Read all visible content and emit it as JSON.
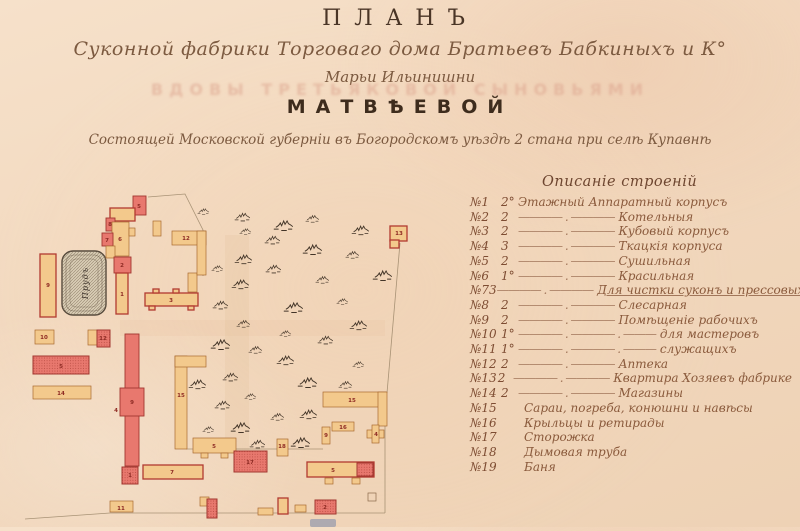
{
  "header": {
    "title": "ПЛАНЪ",
    "subtitle1": "Суконной фабрики Торговаго дома Братьевъ Бабкиныхъ и К°",
    "subtitle2": "Марьи Ильинишни",
    "bleed_through": "ВДОВЫ ТРЕТЬЯКОВОЙ СЫНОВЬЯМИ",
    "owner": "МАТВѢЕВОЙ",
    "location": "Состоящей Московской губерніи въ Богородскомъ уѣздѣ 2 стана при селѣ Купавнѣ"
  },
  "legend": {
    "header": "Описаніе строеній",
    "rows": [
      {
        "num": "№1",
        "storeys": "2°",
        "leader": "",
        "name": "Этажный Аппаратный корпусъ",
        "u": false
      },
      {
        "num": "№2",
        "storeys": "2",
        "leader": "———— . ————",
        "name": "Котельныя",
        "u": false
      },
      {
        "num": "№3",
        "storeys": "2",
        "leader": "———— . ————",
        "name": "Кубовый корпусъ",
        "u": false
      },
      {
        "num": "№4",
        "storeys": "3",
        "leader": "———— . ————",
        "name": "Ткацкія корпуса",
        "u": false
      },
      {
        "num": "№5",
        "storeys": "2",
        "leader": "———— . ————",
        "name": "Сушильная",
        "u": false
      },
      {
        "num": "№6",
        "storeys": "1°",
        "leader": "———— . ————",
        "name": "Красильная",
        "u": false
      },
      {
        "num": "№7",
        "storeys": "3",
        "leader": "———— . ————",
        "name": "Для чистки суконъ и прессовыхъ",
        "u": true
      },
      {
        "num": "№8",
        "storeys": "2",
        "leader": "———— . ————",
        "name": "Слесарная",
        "u": false
      },
      {
        "num": "№9",
        "storeys": "2",
        "leader": "———— . ————",
        "name": "Помѣщеніе рабочихъ",
        "u": false
      },
      {
        "num": "№10",
        "storeys": "1°",
        "leader": "———— . ———— . ———",
        "name": "для мастеровъ",
        "u": false
      },
      {
        "num": "№11",
        "storeys": "1°",
        "leader": "———— . ———— . ———",
        "name": "служащихъ",
        "u": false
      },
      {
        "num": "№12",
        "storeys": "2",
        "leader": "———— . ————",
        "name": "Аптека",
        "u": false
      },
      {
        "num": "№13",
        "storeys": "2",
        "leader": "———— . ————",
        "name": "Квартира Хозяевъ фабрике",
        "u": false
      },
      {
        "num": "№14",
        "storeys": "2",
        "leader": "———— . ————",
        "name": "Магазины",
        "u": false
      },
      {
        "num": "№15",
        "storeys": "",
        "leader": "",
        "name": "Сараи, погреба, конюшни и навѣсы",
        "u": false
      },
      {
        "num": "№16",
        "storeys": "",
        "leader": "",
        "name": "Крыльцы и ретирады",
        "u": false
      },
      {
        "num": "№17",
        "storeys": "",
        "leader": "",
        "name": "Сторожка",
        "u": false
      },
      {
        "num": "№18",
        "storeys": "",
        "leader": "",
        "name": "Дымовая труба",
        "u": false
      },
      {
        "num": "№19",
        "storeys": "",
        "leader": "",
        "name": "Баня",
        "u": false
      }
    ]
  },
  "map": {
    "colors": {
      "red_fill": "#e8786e",
      "red_stroke": "#a23730",
      "red_dot": "#b84c42",
      "tan_fill": "#f3c98c",
      "tan_stroke": "#a96a30",
      "tan_red_stroke": "#b23a31",
      "outline_ink": "#9b8668",
      "tree_ink": "#433528",
      "label_ink": "#8e2b24",
      "pond_fill": "#d8ccb4",
      "pond_stroke": "#564a3c"
    },
    "pond": {
      "x": 37,
      "y": 71,
      "w": 44,
      "h": 64,
      "label": "Прудъ"
    },
    "outlines": [
      {
        "points": [
          [
            123,
            17
          ],
          [
            160,
            14
          ],
          [
            178,
            50
          ],
          [
            178,
            96
          ]
        ]
      },
      {
        "points": [
          [
            375,
            63
          ],
          [
            362,
            213
          ]
        ]
      },
      {
        "points": [
          [
            161,
            269
          ],
          [
            298,
            269
          ]
        ]
      },
      {
        "points": [
          [
            360,
            245
          ],
          [
            360,
            333
          ]
        ]
      },
      {
        "points": [
          [
            85,
            333
          ],
          [
            360,
            333
          ]
        ]
      },
      {
        "points": [
          [
            0,
            339
          ],
          [
            85,
            333
          ]
        ]
      }
    ],
    "buildings": [
      {
        "rects": [
          [
            108,
            16,
            13,
            19
          ]
        ],
        "style": "red",
        "label": "5",
        "lx": 114,
        "ly": 28
      },
      {
        "rects": [
          [
            85,
            28,
            25,
            13
          ]
        ],
        "style": "tanRed"
      },
      {
        "rects": [
          [
            128,
            41,
            8,
            15
          ]
        ],
        "style": "tan"
      },
      {
        "rects": [
          [
            81,
            38,
            9,
            13
          ]
        ],
        "style": "red",
        "label": "8",
        "lx": 85,
        "ly": 46
      },
      {
        "rects": [
          [
            87,
            42,
            17,
            34
          ]
        ],
        "style": "tan",
        "label": "6",
        "lx": 95,
        "ly": 61
      },
      {
        "rects": [
          [
            104,
            48,
            6,
            8
          ]
        ],
        "style": "tan"
      },
      {
        "rects": [
          [
            77,
            53,
            11,
            13
          ]
        ],
        "style": "red",
        "label": "7",
        "lx": 82,
        "ly": 62
      },
      {
        "rects": [
          [
            81,
            66,
            9,
            12
          ]
        ],
        "style": "tan"
      },
      {
        "rects": [
          [
            89,
            77,
            17,
            16
          ]
        ],
        "style": "red",
        "label": "2",
        "lx": 97,
        "ly": 87
      },
      {
        "rects": [
          [
            91,
            93,
            12,
            41
          ]
        ],
        "style": "tanRed",
        "label": "1",
        "lx": 97,
        "ly": 116
      },
      {
        "rects": [
          [
            163,
            93,
            9,
            19
          ]
        ],
        "style": "tan"
      },
      {
        "rects": [
          [
            120,
            113,
            53,
            13
          ],
          [
            128,
            109,
            6,
            4
          ],
          [
            148,
            109,
            6,
            4
          ],
          [
            124,
            126,
            6,
            4
          ],
          [
            163,
            126,
            6,
            4
          ]
        ],
        "style": "tanRed",
        "label": "3",
        "lx": 146,
        "ly": 122
      },
      {
        "rects": [
          [
            147,
            51,
            34,
            14
          ],
          [
            172,
            51,
            9,
            44
          ]
        ],
        "style": "tan",
        "label": "12",
        "lx": 161,
        "ly": 60
      },
      {
        "rects": [
          [
            15,
            74,
            16,
            63
          ]
        ],
        "style": "tanRed",
        "label": "9",
        "lx": 23,
        "ly": 107
      },
      {
        "rects": [
          [
            10,
            150,
            19,
            14
          ]
        ],
        "style": "tan",
        "label": "10",
        "lx": 19,
        "ly": 159
      },
      {
        "rects": [
          [
            63,
            150,
            9,
            15
          ]
        ],
        "style": "tan"
      },
      {
        "rects": [
          [
            72,
            150,
            13,
            17
          ]
        ],
        "style": "redDot",
        "label": "12",
        "lx": 78,
        "ly": 160
      },
      {
        "rects": [
          [
            8,
            176,
            56,
            18
          ]
        ],
        "style": "redDot",
        "label": "5",
        "lx": 36,
        "ly": 188
      },
      {
        "rects": [
          [
            8,
            206,
            58,
            13
          ]
        ],
        "style": "tan",
        "label": "14",
        "lx": 36,
        "ly": 215
      },
      {
        "rects": [
          [
            100,
            154,
            14,
            132
          ]
        ],
        "style": "red"
      },
      {
        "rects": [
          [
            95,
            208,
            24,
            28
          ]
        ],
        "style": "red",
        "label": "9",
        "lx": 107,
        "ly": 224
      },
      {
        "rects": [],
        "style": "red",
        "label": "4",
        "lx": 91,
        "ly": 232
      },
      {
        "rects": [
          [
            97,
            287,
            16,
            17
          ]
        ],
        "style": "redDot",
        "label": "1",
        "lx": 105,
        "ly": 297
      },
      {
        "rects": [
          [
            118,
            285,
            60,
            14
          ]
        ],
        "style": "tanRed",
        "label": "7",
        "lx": 147,
        "ly": 294
      },
      {
        "rects": [
          [
            85,
            321,
            23,
            11
          ]
        ],
        "style": "tan",
        "label": "11",
        "lx": 96,
        "ly": 330
      },
      {
        "rects": [
          [
            150,
            176,
            12,
            93
          ],
          [
            150,
            176,
            31,
            11
          ]
        ],
        "style": "tan",
        "label": "15",
        "lx": 156,
        "ly": 217
      },
      {
        "rects": [
          [
            168,
            258,
            43,
            15
          ],
          [
            176,
            273,
            7,
            5
          ],
          [
            196,
            273,
            7,
            5
          ]
        ],
        "style": "tan",
        "label": "5",
        "lx": 189,
        "ly": 268
      },
      {
        "rects": [
          [
            209,
            271,
            33,
            21
          ]
        ],
        "style": "redDot",
        "label": "17",
        "lx": 225,
        "ly": 284
      },
      {
        "rects": [
          [
            252,
            259,
            11,
            17
          ]
        ],
        "style": "tan",
        "label": "18",
        "lx": 257,
        "ly": 268
      },
      {
        "rects": [
          [
            175,
            317,
            9,
            9
          ]
        ],
        "style": "tan"
      },
      {
        "rects": [
          [
            182,
            319,
            10,
            19
          ]
        ],
        "style": "redDot"
      },
      {
        "rects": [
          [
            233,
            328,
            15,
            7
          ]
        ],
        "style": "tan"
      },
      {
        "rects": [
          [
            253,
            318,
            10,
            16
          ]
        ],
        "style": "tanRed"
      },
      {
        "rects": [
          [
            270,
            325,
            11,
            7
          ]
        ],
        "style": "tan"
      },
      {
        "rects": [
          [
            290,
            320,
            21,
            14
          ]
        ],
        "style": "redDot",
        "label": "2",
        "lx": 300,
        "ly": 329
      },
      {
        "rects": [
          [
            343,
            313,
            8,
            8
          ]
        ],
        "style": "outline"
      },
      {
        "rects": [
          [
            298,
            212,
            63,
            15
          ],
          [
            353,
            212,
            9,
            34
          ]
        ],
        "style": "tan",
        "label": "15",
        "lx": 327,
        "ly": 222
      },
      {
        "rects": [
          [
            307,
            242,
            22,
            9
          ]
        ],
        "style": "tan",
        "label": "16",
        "lx": 318,
        "ly": 249
      },
      {
        "rects": [
          [
            297,
            247,
            8,
            17
          ]
        ],
        "style": "tan",
        "label": "9",
        "lx": 301,
        "ly": 257
      },
      {
        "rects": [
          [
            342,
            250,
            17,
            8
          ],
          [
            347,
            245,
            7,
            18
          ]
        ],
        "style": "tan",
        "label": "4",
        "lx": 351,
        "ly": 256
      },
      {
        "rects": [
          [
            282,
            282,
            67,
            15
          ]
        ],
        "style": "tanRed",
        "label": "5",
        "lx": 308,
        "ly": 292
      },
      {
        "rects": [
          [
            332,
            283,
            16,
            13
          ]
        ],
        "style": "redDot"
      },
      {
        "rects": [
          [
            300,
            298,
            8,
            6
          ],
          [
            327,
            298,
            8,
            6
          ]
        ],
        "style": "tan"
      },
      {
        "rects": [
          [
            365,
            46,
            17,
            15
          ],
          [
            365,
            60,
            9,
            8
          ]
        ],
        "style": "tanRed",
        "label": "13",
        "lx": 374,
        "ly": 55
      }
    ],
    "trees": [
      [
        178,
        30
      ],
      [
        217,
        35
      ],
      [
        258,
        43
      ],
      [
        287,
        37
      ],
      [
        335,
        48
      ],
      [
        220,
        50
      ],
      [
        247,
        58
      ],
      [
        287,
        67
      ],
      [
        327,
        73
      ],
      [
        218,
        77
      ],
      [
        192,
        87
      ],
      [
        248,
        87
      ],
      [
        357,
        93
      ],
      [
        297,
        98
      ],
      [
        215,
        102
      ],
      [
        317,
        120
      ],
      [
        195,
        123
      ],
      [
        268,
        125
      ],
      [
        218,
        142
      ],
      [
        333,
        143
      ],
      [
        260,
        152
      ],
      [
        300,
        158
      ],
      [
        195,
        162
      ],
      [
        230,
        168
      ],
      [
        260,
        178
      ],
      [
        333,
        183
      ],
      [
        205,
        195
      ],
      [
        282,
        200
      ],
      [
        320,
        203
      ],
      [
        172,
        202
      ],
      [
        225,
        215
      ],
      [
        197,
        223
      ],
      [
        215,
        245
      ],
      [
        252,
        235
      ],
      [
        283,
        232
      ],
      [
        183,
        248
      ],
      [
        232,
        262
      ],
      [
        275,
        260
      ]
    ]
  }
}
